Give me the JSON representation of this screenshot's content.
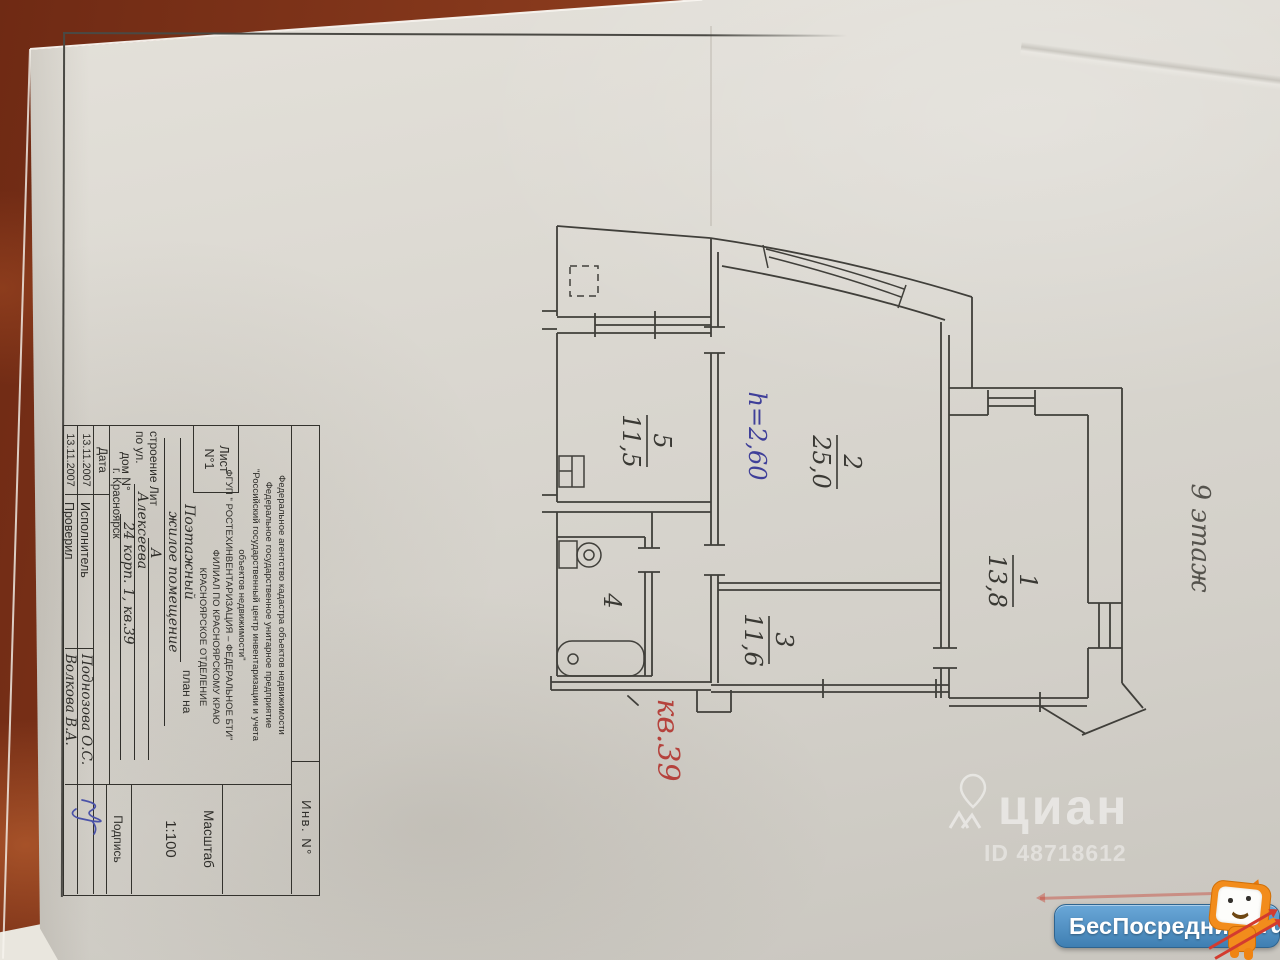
{
  "palette": {
    "table_bg": "#7c3018",
    "paper": "#d8d5ce",
    "line": "#403f3a",
    "ink_blue": "#3f3f99",
    "ink_red": "#b5423c",
    "signature_blue": "#4a52a8",
    "watermark_white": "rgba(255,255,255,0.5)",
    "banner_blue": "#4f8fc0",
    "mascot_orange": "#f28c1c"
  },
  "stamp": {
    "agency_lines": [
      "Федеральное агентство кадастра объектов недвижимости",
      "Федеральное государственное унитарное предприятие",
      "\"Российский государственный центр инвентаризации и учета",
      "объектов недвижимости\"",
      "ФГУП \" РОСТЕХИНВЕНТАРИЗАЦИЯ – ФЕДЕРАЛЬНОЕ БТИ\"",
      "ФИЛИАЛ ПО КРАСНОЯРСКОМУ КРАЮ",
      "КРАСНОЯРСКОЕ ОТДЕЛЕНИЕ"
    ],
    "sheet_label": "Лист",
    "sheet_no": "N°1",
    "inventory_label": "Инв. N°",
    "title_hw_1": "Поэтажный",
    "title_printed": "план на",
    "title_hw_2": "жилое помещение",
    "building_label": "строение Лит",
    "building_value": "А",
    "street_label": "по ул.",
    "street_value": "Алексеева",
    "house_label": "дом N°",
    "house_value": "24 корп. 1, кв.39",
    "city": "г. Красноярск",
    "scale_label": "Масштаб",
    "scale_value": "1:100",
    "signature_label": "Подпись",
    "date_label": "Дата",
    "rows": [
      {
        "role": "Исполнитель",
        "name": "Поднозова О.С.",
        "date": "13.11.2007"
      },
      {
        "role": "Проверил",
        "name": "Волкова В.А.",
        "date": "13.11.2007"
      }
    ]
  },
  "plan": {
    "rooms": [
      {
        "number": "1",
        "area": "13,8"
      },
      {
        "number": "2",
        "area": "25,0"
      },
      {
        "number": "3",
        "area": "11,6"
      },
      {
        "number": "4",
        "area": ""
      },
      {
        "number": "5",
        "area": "11,5"
      }
    ],
    "ceiling_height": "h=2,60",
    "apartment": "кв.39",
    "floor_note": "9 этаж"
  },
  "watermark": {
    "brand": "циан",
    "id_text": "ID 48718612"
  },
  "badge": {
    "site_name": "БесПосредника",
    "site_tld": ".ru"
  }
}
